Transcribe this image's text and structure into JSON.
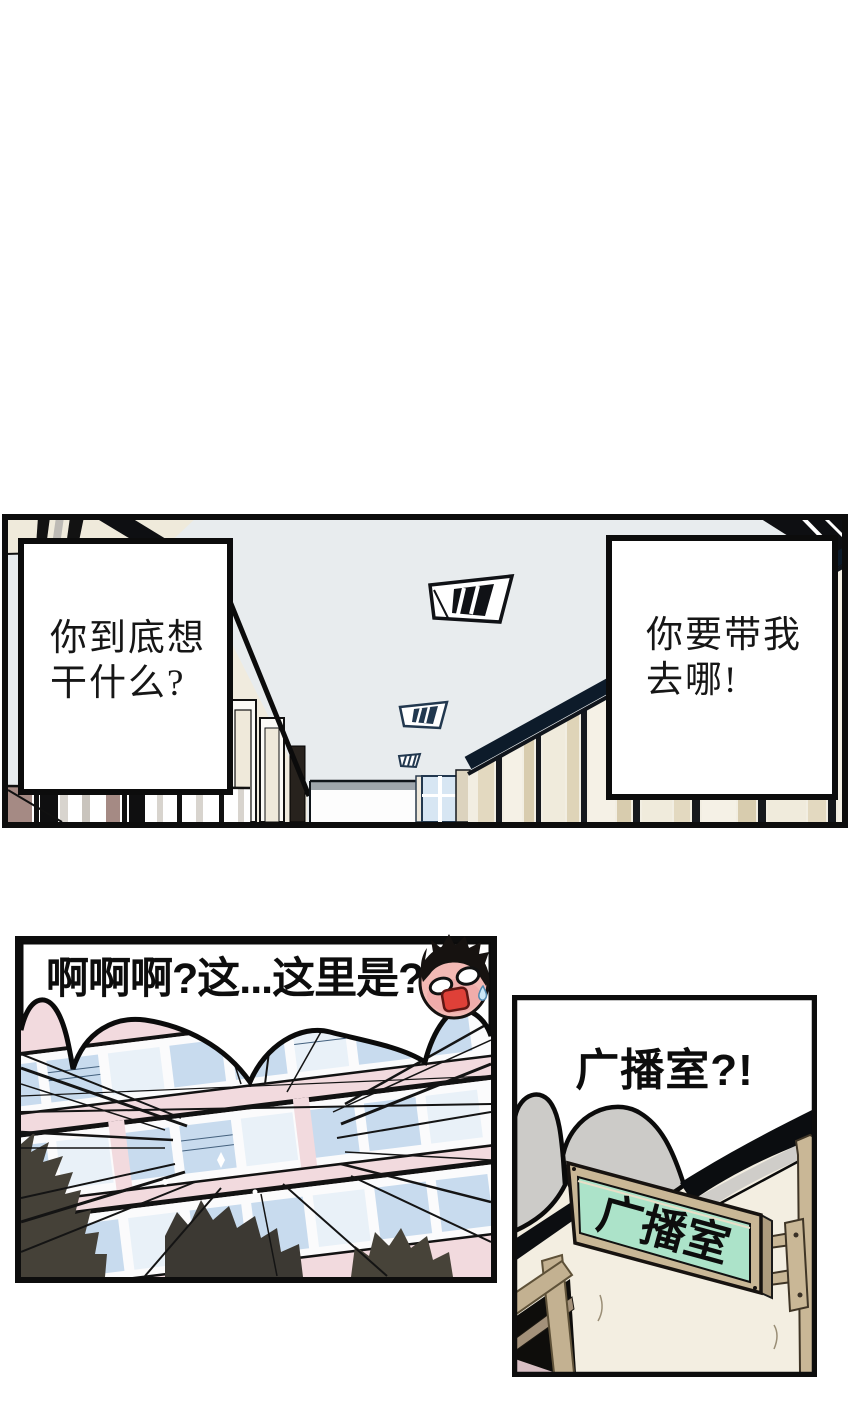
{
  "page": {
    "background": "#ffffff"
  },
  "hallway_panel": {
    "bubble_left": {
      "line1": "你到底想",
      "line2": "干什么?"
    },
    "bubble_right": {
      "line1": "你要带我",
      "line2": "去哪!"
    }
  },
  "flashback_panel": {
    "shout": "啊啊啊?这...这里是?!"
  },
  "broadcast_panel": {
    "exclaim": "广播室?!",
    "sign_label": "广播室"
  },
  "icons": {
    "shocked_face": "shocked-chibi-face-icon",
    "ceiling_light": "fluorescent-ceiling-light-icon",
    "sweat_drop": "sweat-drop-icon"
  },
  "colors": {
    "panel_border": "#0d0d0d",
    "ceiling_gray": "#e8ecee",
    "wall_cream": "#f0ebde",
    "wall_beige": "#e6dcc4",
    "locker_mauve": "#a58a84",
    "navy_outline": "#25405c",
    "building_pink": "#f2dade",
    "window_blue": "#c8dbee",
    "cloud_gray": "#cccbc8",
    "sign_green": "#ace3c9",
    "sign_frame_tan": "#c8b493",
    "mouth_red": "#df4038"
  }
}
